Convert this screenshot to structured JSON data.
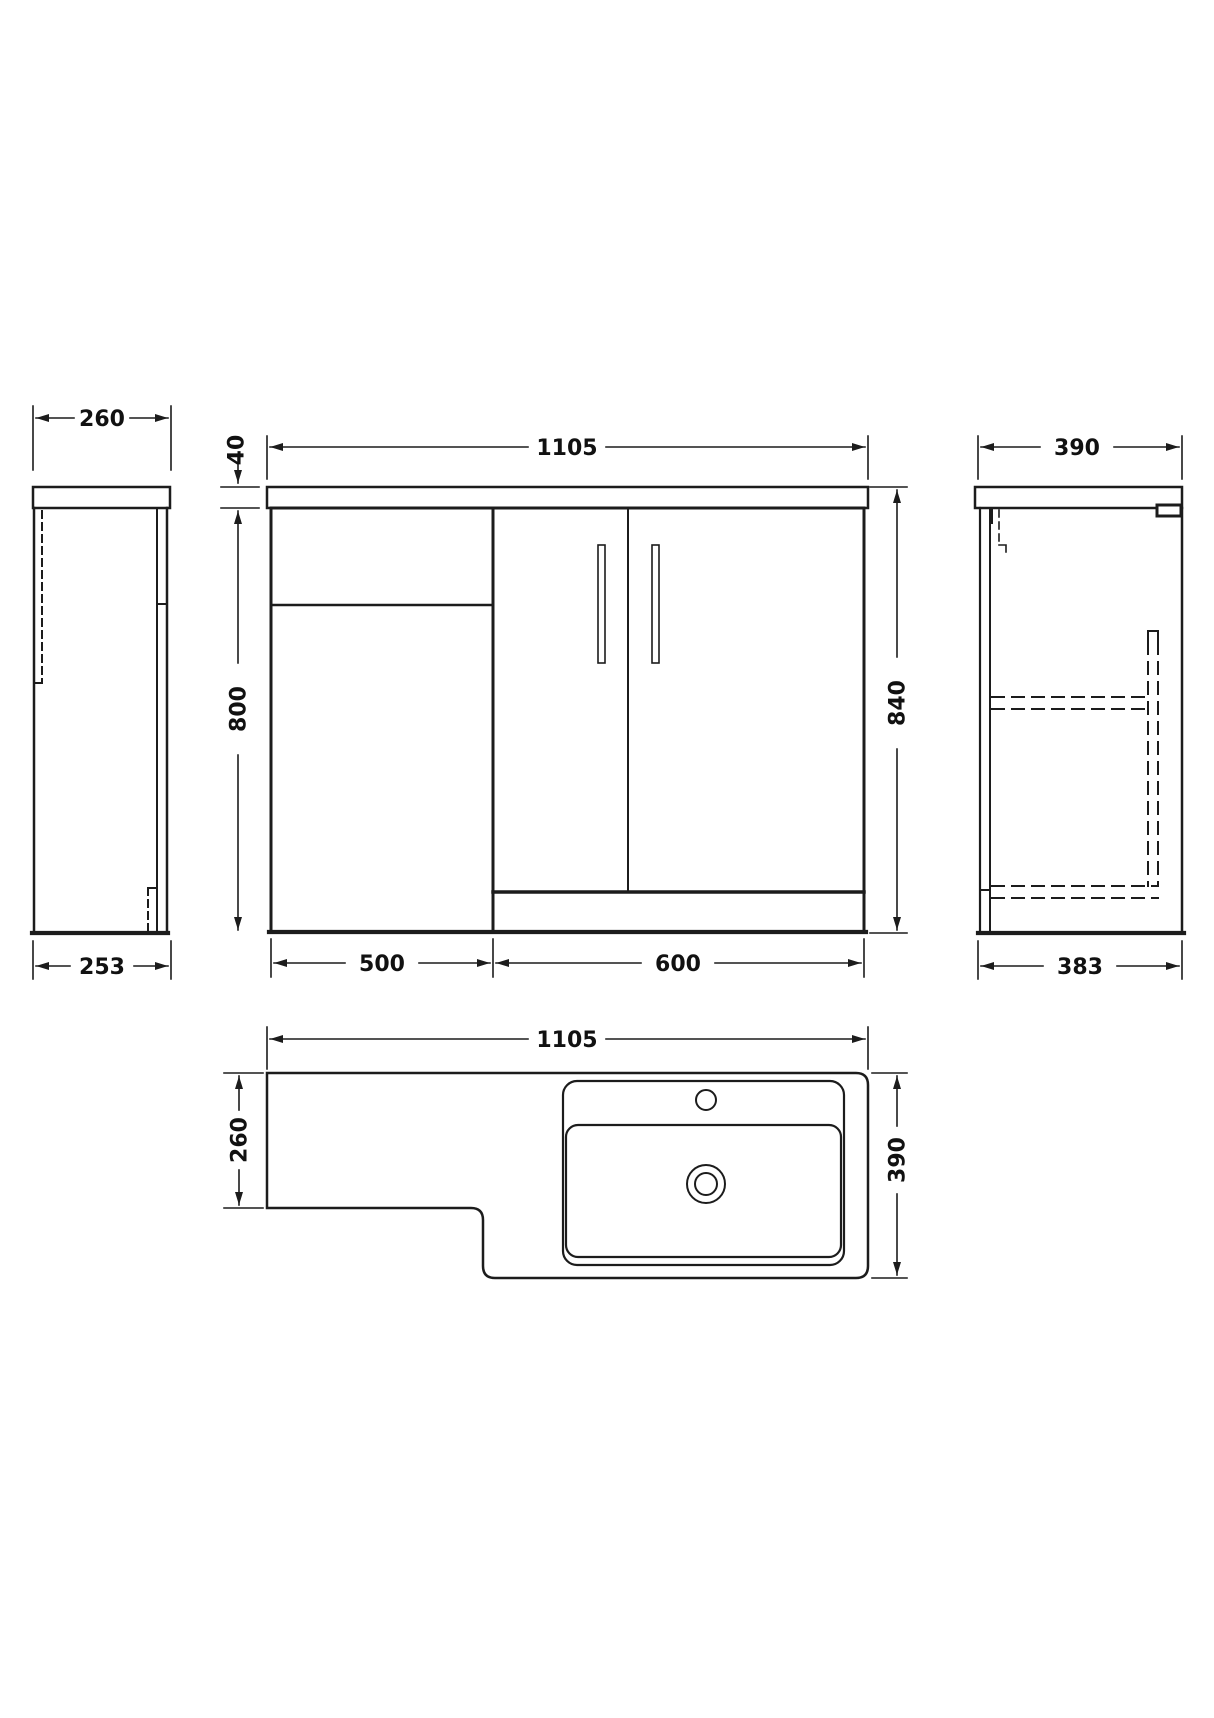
{
  "drawing": {
    "type": "technical-dimension-drawing",
    "colors": {
      "line": "#1c1c1c",
      "background": "#ffffff",
      "text": "#111111"
    },
    "dims": {
      "left_side_top_width": "260",
      "left_side_bottom_width": "253",
      "front_overall_width": "1105",
      "front_worktop_thickness": "40",
      "front_cabinet_height": "800",
      "front_overall_height": "840",
      "front_left_section_width": "500",
      "front_right_section_width": "600",
      "right_side_top_depth": "390",
      "right_side_bottom_depth": "383",
      "plan_overall_width": "1105",
      "plan_left_depth": "260",
      "plan_right_depth": "390"
    }
  }
}
